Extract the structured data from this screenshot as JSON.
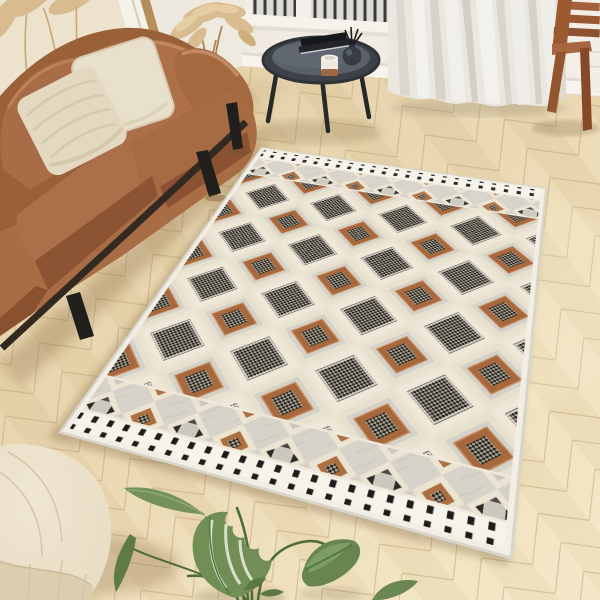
{
  "scene": {
    "description": "Bright living-room product photo: geometric boho area rug with diamond pattern on a light herringbone oak floor, cognac leather sofa with cream pillows, round black coffee table with books / candle / reed diffuser, sheer white curtain over a window with dark railing bars, wooden chair, framed pampas artwork, dried pampas grass, cream pouf and a monstera plant in the foreground",
    "objects": [
      {
        "label": "wall"
      },
      {
        "label": "framed-pampas-art"
      },
      {
        "label": "window-with-railing"
      },
      {
        "label": "sheer-curtain"
      },
      {
        "label": "wooden-chair"
      },
      {
        "label": "herringbone-floor"
      },
      {
        "label": "leather-sofa"
      },
      {
        "label": "throw-pillows"
      },
      {
        "label": "pampas-grass"
      },
      {
        "label": "round-coffee-table"
      },
      {
        "label": "books"
      },
      {
        "label": "candle"
      },
      {
        "label": "reed-diffuser"
      },
      {
        "label": "geometric-area-rug"
      },
      {
        "label": "cream-pouf"
      },
      {
        "label": "monstera-plant"
      }
    ],
    "palette": {
      "wall": "#f0ebe1",
      "floor_light": "#f3e6c4",
      "floor_mid": "#e9d6ae",
      "floor_dark": "#e0cba1",
      "sofa_leather": "#a76c45",
      "sofa_leather_dark": "#8c5433",
      "pillow_cream": "#e8dfca",
      "pouf_cream": "#e7dcc2",
      "curtain": "#eae7e0",
      "table_top": "#3d4248",
      "table_tray": "#596068",
      "chair_wood": "#9c5a30",
      "plant_green": "#6c8950",
      "plant_green_dark": "#546f3d",
      "rug_field_gray": "#cfccc3",
      "rug_cream": "#ece4d3",
      "rug_white": "#f2eee4",
      "rug_dark": "#24231f",
      "rug_dark_weave": "#a79f90",
      "rug_brown": "#ad6b3f",
      "rug_black_motif": "#1d1d1b"
    }
  },
  "rug": {
    "design_size": [
      320,
      420
    ],
    "corners": {
      "tl": [
        261,
        147
      ],
      "tr": [
        547,
        188
      ],
      "br": [
        513,
        560
      ],
      "bl": [
        58,
        433
      ]
    }
  }
}
